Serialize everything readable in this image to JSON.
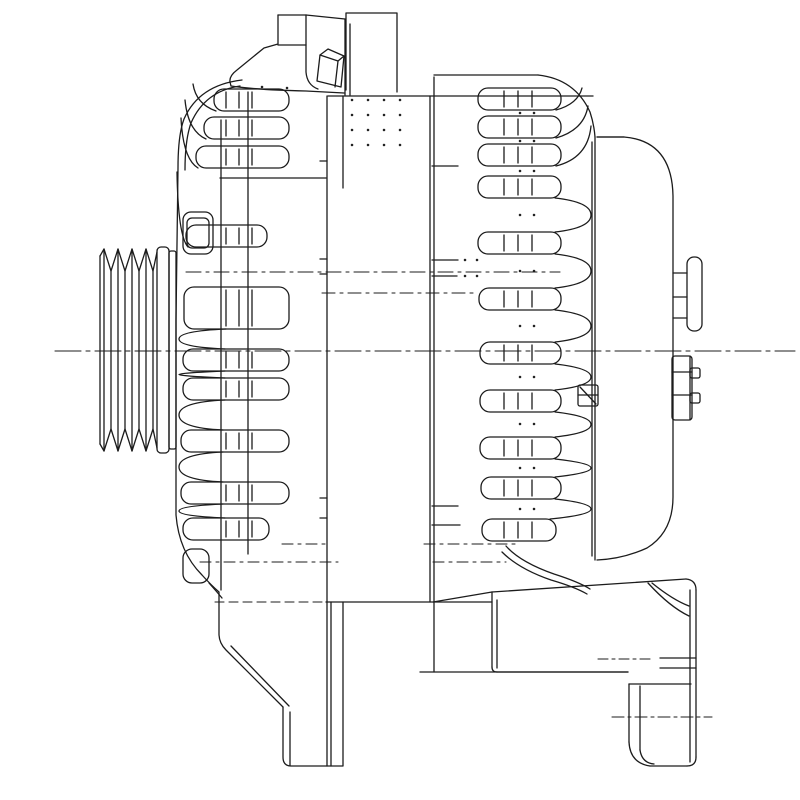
{
  "meta": {
    "title": "Technical line drawing - alternator side view with belt pulley",
    "background": "#ffffff",
    "ink": "#1c1c1c",
    "stroke_width": 1.3
  },
  "drawing": {
    "canvas": {
      "w": 800,
      "h": 800
    },
    "parts": [
      "belt-pulley",
      "front-housing",
      "front-vent-fins",
      "stator-band",
      "rear-vent-fins",
      "rear-cover",
      "terminal-stud",
      "terminal-nut",
      "top-mounting-lug",
      "front-mounting-foot",
      "rear-mounting-bracket",
      "axis-centerlines"
    ],
    "pulley": {
      "groove_count": 4,
      "ridge_xs": [
        104,
        118,
        132,
        146
      ],
      "valley_xs": [
        111,
        125,
        139,
        153
      ]
    },
    "front_fins": {
      "cap_side": "right",
      "link_side": "left",
      "link_x": 179,
      "tick_xs": [
        226,
        239,
        252
      ],
      "bars": [
        {
          "y": 89,
          "x1": 214,
          "x2": 289
        },
        {
          "y": 117,
          "x1": 204,
          "x2": 289
        },
        {
          "y": 146,
          "x1": 196,
          "x2": 289
        },
        {
          "y": 225,
          "x1": 186,
          "x2": 267
        },
        {
          "y": 287,
          "x1": 184,
          "x2": 289,
          "h": 42
        },
        {
          "y": 349,
          "x1": 183,
          "x2": 289
        },
        {
          "y": 378,
          "x1": 183,
          "x2": 289
        },
        {
          "y": 430,
          "x1": 181,
          "x2": 289
        },
        {
          "y": 482,
          "x1": 181,
          "x2": 289
        },
        {
          "y": 518,
          "x1": 183,
          "x2": 269
        }
      ],
      "links": [
        [
          4,
          5
        ],
        [
          5,
          6
        ],
        [
          6,
          7
        ],
        [
          7,
          8
        ],
        [
          8,
          9
        ]
      ]
    },
    "rear_fins": {
      "cap_side": "left",
      "link_side": "right",
      "link_x": 591,
      "tick_xs": [
        504,
        518,
        532
      ],
      "bars": [
        {
          "y": 88,
          "x1": 478,
          "x2": 561
        },
        {
          "y": 116,
          "x1": 478,
          "x2": 561
        },
        {
          "y": 144,
          "x1": 478,
          "x2": 561
        },
        {
          "y": 176,
          "x1": 478,
          "x2": 561
        },
        {
          "y": 232,
          "x1": 478,
          "x2": 561
        },
        {
          "y": 288,
          "x1": 479,
          "x2": 561
        },
        {
          "y": 342,
          "x1": 480,
          "x2": 561
        },
        {
          "y": 390,
          "x1": 480,
          "x2": 561
        },
        {
          "y": 437,
          "x1": 480,
          "x2": 561
        },
        {
          "y": 477,
          "x1": 481,
          "x2": 561
        },
        {
          "y": 519,
          "x1": 482,
          "x2": 556
        }
      ],
      "links": [
        [
          3,
          4
        ],
        [
          4,
          5
        ],
        [
          5,
          6
        ],
        [
          6,
          7
        ],
        [
          7,
          8
        ],
        [
          8,
          9
        ],
        [
          9,
          10
        ]
      ]
    },
    "paths": [
      {
        "name": "front-housing-left-outline",
        "d": "M 242,80 Q 199,85 184,119 Q 178,135 178,168 L 176,320 L 176,515 Q 179,552 202,575 Q 211,585 219,592 L 219,634 Q 219,643 226,650 L 283,707"
      },
      {
        "name": "front-foot-outline",
        "d": "M 283,707 L 283,757 Q 283,766 291,766 L 343,766 L 343,602"
      },
      {
        "name": "front-housing-inner-curve",
        "d": "M 240,86 Q 205,91 191,123 Q 185,140 185,170"
      },
      {
        "name": "front-fin-fan-1",
        "d": "M 216,111 Q 196,104 193,84"
      },
      {
        "name": "front-fin-fan-2",
        "d": "M 206,139 Q 188,131 185,100"
      },
      {
        "name": "front-fin-fan-3",
        "d": "M 198,168 Q 183,159 181,118"
      },
      {
        "name": "front-fin-fan-4",
        "d": "M 188,247 Q 178,236 177,172"
      },
      {
        "name": "lug-left-outline",
        "d": "M 278,15 L 278,44 L 264,48 L 237,70 Q 229,76 230,82 L 231,86"
      },
      {
        "name": "lug-bottom-edge",
        "d": "M 231,86 Q 258,90 306,91 L 344,93"
      },
      {
        "name": "lug-inner-edge",
        "d": "M 306,15 L 306,72 Q 307,85 318,89"
      },
      {
        "name": "lug-rear-ear",
        "d": "M 346,90 L 346,13 L 397,13 L 397,92"
      },
      {
        "name": "lug-bolt-boss",
        "d": "M 317,81 L 320,55 L 328,49 L 344,56 L 341,87 Z"
      },
      {
        "name": "lug-bolt-boss-inner",
        "d": "M 320,55 L 338,61 L 335,87"
      },
      {
        "name": "rear-shell-top-curve",
        "d": "M 538,75 Q 575,79 590,112 Q 594,124 595,137"
      },
      {
        "name": "rear-cover-outline",
        "d": "M 597,137 L 624,137 Q 672,141 673,196 L 673,497 Q 673,532 647,548 Q 623,559 597,560"
      },
      {
        "name": "rear-fin-fan-1",
        "d": "M 556,110 Q 578,104 582,88"
      },
      {
        "name": "rear-fin-fan-2",
        "d": "M 556,138 Q 584,130 588,106"
      },
      {
        "name": "rear-fin-fan-3",
        "d": "M 556,166 Q 588,158 591,126"
      },
      {
        "name": "rear-swoosh-outer",
        "d": "M 506,546 Q 520,562 554,574 Q 579,582 590,589"
      },
      {
        "name": "rear-swoosh-inner",
        "d": "M 502,552 Q 519,569 551,580 Q 575,587 587,594"
      },
      {
        "name": "bracket-corner-top-right",
        "d": "M 686,579 Q 696,580 696,590"
      },
      {
        "name": "bracket-corner-bottom-right",
        "d": "M 696,757 Q 696,766 687,766"
      },
      {
        "name": "bracket-foot-left-curve",
        "d": "M 650,766 Q 630,763 629,742"
      },
      {
        "name": "bracket-corner-bottom-left",
        "d": "M 497,672 Q 492,672 492,667"
      },
      {
        "name": "bracket-gusset-a",
        "d": "M 648,583 Q 670,607 689,616"
      },
      {
        "name": "bracket-gusset-b",
        "d": "M 652,583 Q 673,600 689,606"
      },
      {
        "name": "bracket-foot-inner-curve",
        "d": "M 640,750 Q 642,763 654,764"
      },
      {
        "name": "front-bottom-slot-curve",
        "d": "M 209,583 Q 217,592 222,598"
      },
      {
        "name": "pulley-groove-profile-top",
        "d": "M 100,256 L 104,249 L 111,271 L 118,249 L 125,271 L 132,249 L 139,271 L 146,249 L 153,271 L 157,252"
      },
      {
        "name": "pulley-groove-profile-bottom",
        "d": "M 100,444 L 104,451 L 111,429 L 118,451 L 125,429 L 132,451 L 139,429 L 146,451 L 153,429 L 157,448"
      }
    ],
    "rects": [
      {
        "name": "pulley-flange",
        "x": 157,
        "y": 247,
        "w": 12,
        "h": 206,
        "rx": 4
      },
      {
        "name": "pulley-hub-plate",
        "x": 169,
        "y": 251,
        "w": 7,
        "h": 198,
        "rx": 2
      },
      {
        "name": "front-boss-pad-outer",
        "x": 183,
        "y": 212,
        "w": 30,
        "h": 42,
        "rx": 8
      },
      {
        "name": "front-boss-pad-inner",
        "x": 187,
        "y": 218,
        "w": 22,
        "h": 30,
        "rx": 5
      },
      {
        "name": "front-bottom-slot",
        "x": 183,
        "y": 549,
        "w": 26,
        "h": 34,
        "rx": 9
      },
      {
        "name": "terminal-stud",
        "x": 687,
        "y": 257,
        "w": 15,
        "h": 74,
        "rx": 7
      },
      {
        "name": "terminal-nut",
        "x": 672,
        "y": 356,
        "w": 20,
        "h": 64,
        "rx": 3
      },
      {
        "name": "nut-tab-upper",
        "x": 690,
        "y": 368,
        "w": 10,
        "h": 10,
        "rx": 2
      },
      {
        "name": "nut-tab-lower",
        "x": 690,
        "y": 393,
        "w": 10,
        "h": 10,
        "rx": 2
      },
      {
        "name": "through-bolt-head",
        "x": 578,
        "y": 385,
        "w": 20,
        "h": 21,
        "rx": 2
      }
    ],
    "segments": [
      [
        306,
        15,
        278,
        15
      ],
      [
        306,
        15,
        345,
        19
      ],
      [
        345,
        19,
        345,
        95
      ],
      [
        350,
        24,
        350,
        95
      ],
      [
        278,
        45,
        306,
        45
      ],
      [
        338,
        61,
        344,
        56
      ],
      [
        328,
        96,
        593,
        96
      ],
      [
        434,
        75,
        538,
        75
      ],
      [
        597,
        137,
        624,
        137
      ],
      [
        221,
        120,
        221,
        590
      ],
      [
        248,
        92,
        248,
        554
      ],
      [
        327,
        96,
        327,
        766
      ],
      [
        331,
        602,
        331,
        766
      ],
      [
        343,
        96,
        343,
        188
      ],
      [
        430,
        96,
        430,
        602
      ],
      [
        434,
        77,
        434,
        672
      ],
      [
        595,
        137,
        595,
        560
      ],
      [
        592,
        142,
        592,
        556
      ],
      [
        432,
        166,
        458,
        166
      ],
      [
        432,
        260,
        458,
        260
      ],
      [
        432,
        276,
        457,
        276
      ],
      [
        432,
        506,
        458,
        506
      ],
      [
        432,
        525,
        460,
        525
      ],
      [
        320,
        161,
        327,
        161
      ],
      [
        320,
        259,
        327,
        259
      ],
      [
        320,
        274,
        327,
        274
      ],
      [
        320,
        498,
        327,
        498
      ],
      [
        320,
        518,
        327,
        518
      ],
      [
        220,
        178,
        326,
        178
      ],
      [
        326,
        602,
        492,
        602
      ],
      [
        433,
        602,
        492,
        592
      ],
      [
        420,
        672,
        628,
        672
      ],
      [
        231,
        646,
        289,
        706
      ],
      [
        290,
        712,
        290,
        766
      ],
      [
        492,
        592,
        686,
        579
      ],
      [
        696,
        590,
        696,
        757
      ],
      [
        687,
        766,
        650,
        766
      ],
      [
        629,
        742,
        629,
        684
      ],
      [
        629,
        684,
        691,
        684
      ],
      [
        628,
        672,
        497,
        672
      ],
      [
        492,
        667,
        492,
        592
      ],
      [
        497,
        600,
        497,
        668
      ],
      [
        690,
        590,
        690,
        762
      ],
      [
        660,
        658,
        696,
        658
      ],
      [
        660,
        668,
        696,
        668
      ],
      [
        640,
        686,
        640,
        750
      ],
      [
        673,
        273,
        687,
        273
      ],
      [
        673,
        297,
        687,
        297
      ],
      [
        673,
        318,
        687,
        318
      ],
      [
        672,
        372,
        692,
        372
      ],
      [
        672,
        395,
        692,
        395
      ],
      [
        690,
        356,
        690,
        420
      ],
      [
        578,
        395,
        598,
        395
      ],
      [
        580,
        387,
        596,
        404
      ],
      [
        104,
        249,
        104,
        451
      ],
      [
        118,
        249,
        118,
        451
      ],
      [
        132,
        249,
        132,
        451
      ],
      [
        146,
        249,
        146,
        451
      ],
      [
        111,
        271,
        111,
        429
      ],
      [
        125,
        271,
        125,
        429
      ],
      [
        139,
        271,
        139,
        429
      ],
      [
        153,
        271,
        153,
        429
      ],
      [
        100,
        256,
        100,
        444
      ]
    ],
    "centerlines": [
      {
        "y": 351,
        "x1": 55,
        "x2": 795,
        "dash": "26 5 4 5"
      },
      {
        "y": 272,
        "x1": 186,
        "x2": 560,
        "dash": "15 5 3 5"
      },
      {
        "y": 293,
        "x1": 322,
        "x2": 478,
        "dash": "13 5 3 5"
      },
      {
        "y": 544,
        "x1": 282,
        "x2": 330,
        "dash": "11 5 3 5"
      },
      {
        "y": 544,
        "x1": 424,
        "x2": 520,
        "dash": "11 5 3 5"
      },
      {
        "y": 562,
        "x1": 200,
        "x2": 338,
        "dash": "11 5 3 5"
      },
      {
        "y": 562,
        "x1": 433,
        "x2": 506,
        "dash": "11 5 3 5"
      },
      {
        "y": 602,
        "x1": 215,
        "x2": 326,
        "dash": "9 5"
      },
      {
        "y": 659,
        "x1": 598,
        "x2": 650,
        "dash": "10 4 3 4"
      },
      {
        "y": 717,
        "x1": 612,
        "x2": 712,
        "dash": "12 4 3 4"
      }
    ],
    "dots": [
      [
        352,
        100
      ],
      [
        368,
        100
      ],
      [
        384,
        100
      ],
      [
        400,
        100
      ],
      [
        352,
        115
      ],
      [
        368,
        115
      ],
      [
        384,
        115
      ],
      [
        400,
        115
      ],
      [
        352,
        130
      ],
      [
        368,
        130
      ],
      [
        384,
        130
      ],
      [
        400,
        130
      ],
      [
        352,
        145
      ],
      [
        368,
        145
      ],
      [
        384,
        145
      ],
      [
        400,
        145
      ],
      [
        520,
        113
      ],
      [
        534,
        113
      ],
      [
        520,
        141
      ],
      [
        534,
        141
      ],
      [
        520,
        171
      ],
      [
        534,
        171
      ],
      [
        520,
        215
      ],
      [
        534,
        215
      ],
      [
        520,
        271
      ],
      [
        534,
        271
      ],
      [
        520,
        326
      ],
      [
        534,
        326
      ],
      [
        520,
        377
      ],
      [
        534,
        377
      ],
      [
        520,
        424
      ],
      [
        534,
        424
      ],
      [
        520,
        468
      ],
      [
        534,
        468
      ],
      [
        520,
        509
      ],
      [
        534,
        509
      ],
      [
        465,
        260
      ],
      [
        477,
        260
      ],
      [
        465,
        276
      ],
      [
        477,
        276
      ],
      [
        262,
        87
      ],
      [
        287,
        88
      ]
    ]
  }
}
